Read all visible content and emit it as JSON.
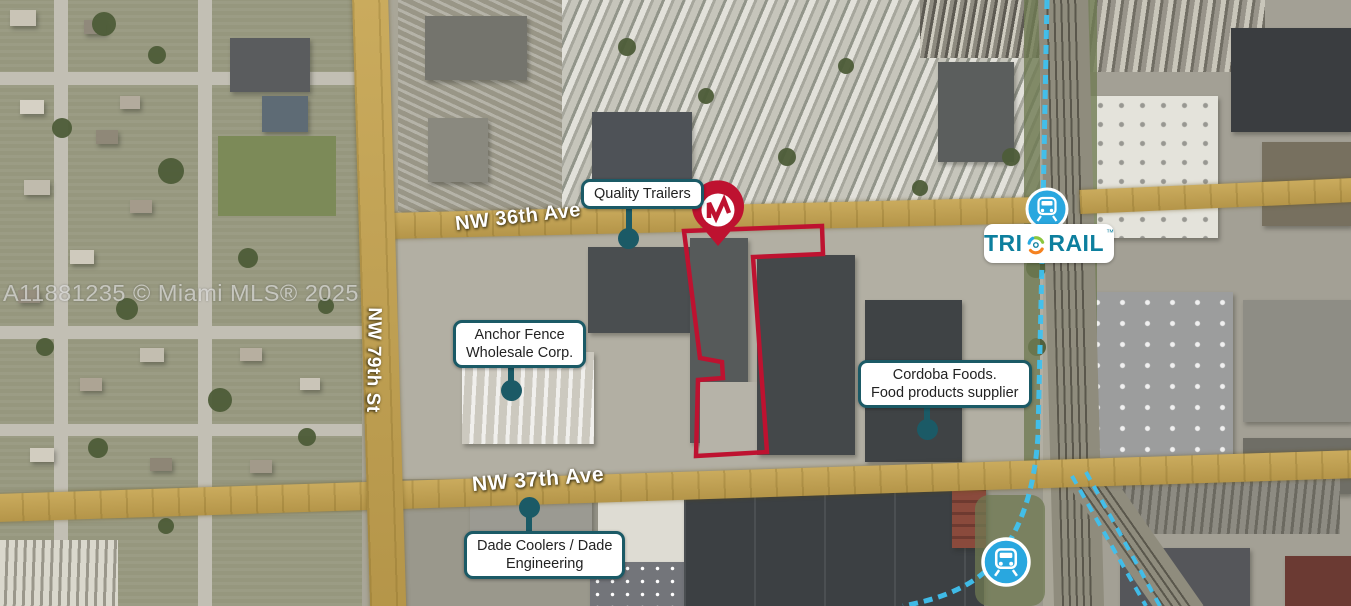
{
  "watermark": "A11881235 © Miami MLS® 2025",
  "streets": {
    "nw36": {
      "label": "NW 36th Ave"
    },
    "nw79": {
      "label": "NW 79th St"
    },
    "nw37": {
      "label": "NW 37th Ave"
    }
  },
  "callouts": {
    "quality": {
      "line1": "Quality Trailers"
    },
    "anchor": {
      "line1": "Anchor Fence",
      "line2": "Wholesale Corp."
    },
    "cordoba": {
      "line1": "Cordoba Foods.",
      "line2": "Food products supplier"
    },
    "dade": {
      "line1": "Dade Coolers / Dade",
      "line2": "Engineering"
    }
  },
  "transit": {
    "brand_left": "TRI",
    "brand_right": "RAIL",
    "trademark": "™"
  },
  "boundary": {
    "points": "684,231 822,226 823,254 753,257 767,452 696,456 698,380 723,378 722,362 700,358"
  },
  "colors": {
    "boundary_red": "#be1230",
    "callout_teal": "#1b5a66",
    "road_highlight": "#c1a050",
    "station_blue": "#29a7df",
    "rail_line_cyan": "#3fc1ef",
    "tri_rail_text": "#0d7f9e",
    "swirl_green": "#8cc63e",
    "swirl_orange": "#f58220",
    "swirl_blue": "#27aae1"
  }
}
